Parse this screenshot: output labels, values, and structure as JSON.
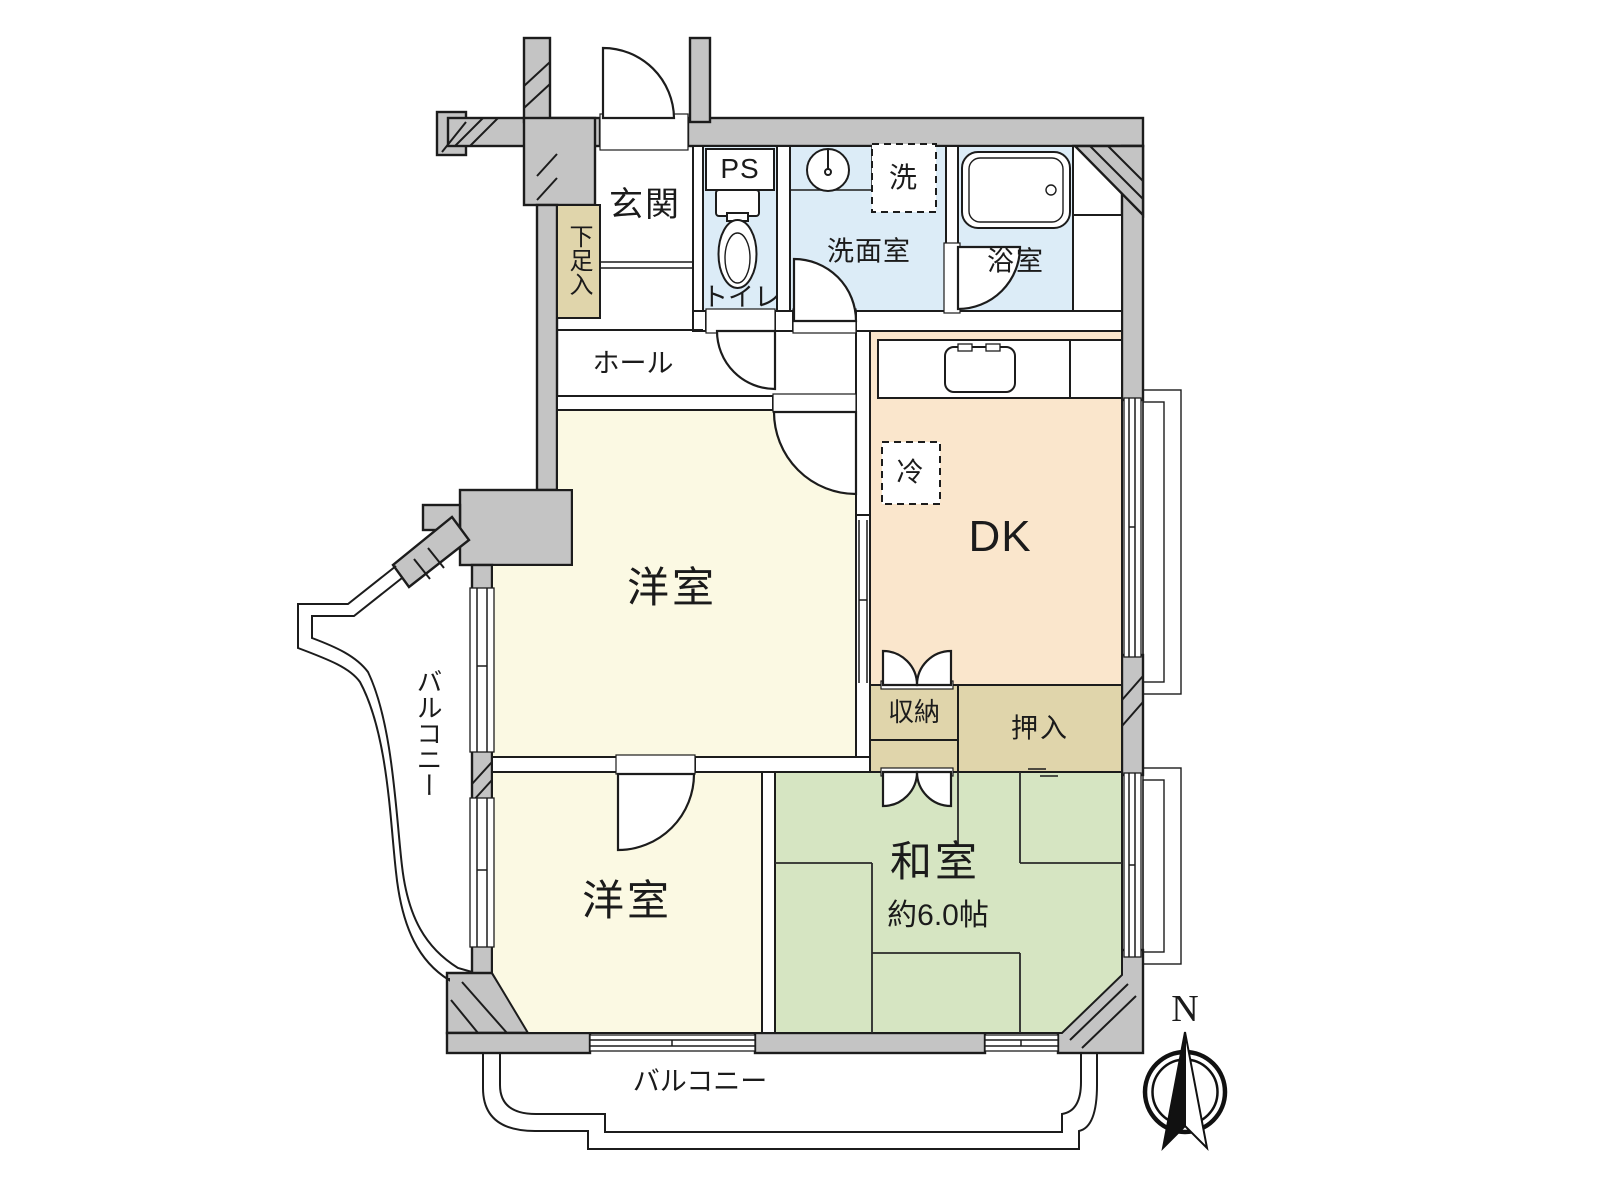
{
  "title": "2DK apartment floor plan",
  "colors": {
    "wall": "#c4c4c4",
    "outline": "#1c1c1c",
    "wet": "#dcecf7",
    "dk": "#fae6cc",
    "western": "#fbf9e3",
    "washitsu": "#d6e5c2",
    "storage": "#e0d5ab"
  },
  "rooms": {
    "genkan": {
      "label": "玄関"
    },
    "shoe_cabinet": {
      "label": "下足入"
    },
    "ps": {
      "label": "PS"
    },
    "toilet": {
      "label": "トイレ"
    },
    "washroom": {
      "label": "洗面室"
    },
    "bathroom": {
      "label": "浴室"
    },
    "hall": {
      "label": "ホール"
    },
    "dk": {
      "label": "DK"
    },
    "western1": {
      "label": "洋室"
    },
    "western2": {
      "label": "洋室"
    },
    "washitsu": {
      "label": "和室",
      "size": "約6.0帖"
    },
    "storage": {
      "label": "収納"
    },
    "oshiire": {
      "label": "押入"
    }
  },
  "fixtures": {
    "laundry": {
      "label": "洗"
    },
    "fridge": {
      "label": "冷"
    }
  },
  "balconies": {
    "left": {
      "label": "バルコニー"
    },
    "bottom": {
      "label": "バルコニー"
    }
  },
  "compass": {
    "north": "N"
  }
}
